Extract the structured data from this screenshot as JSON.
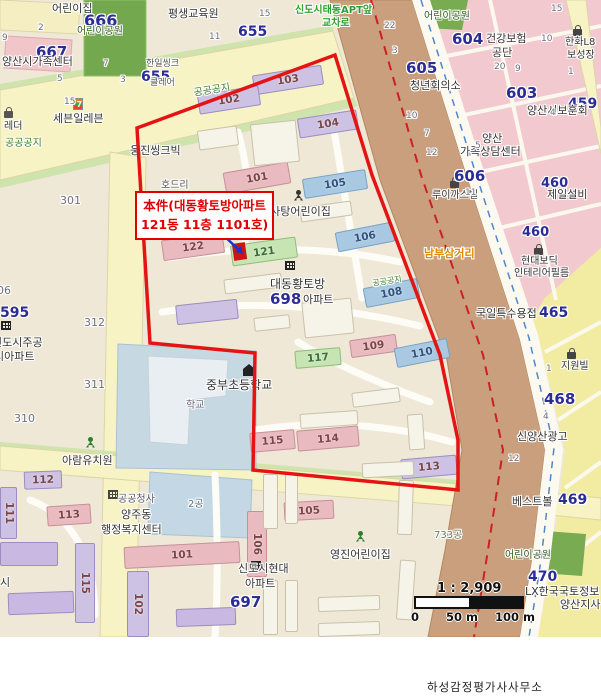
{
  "annotation": {
    "line1": "本件(대동황토방아파트",
    "line2": "121동 11층 1101호)"
  },
  "scale": {
    "ratio": "1 : 2,909",
    "tick0": "0",
    "tick50": "50 m",
    "tick100": "100 m"
  },
  "attribution": "하성감정평가사사무소",
  "colors": {
    "boundary": "#e51414",
    "marker": "#cf1212",
    "arrow": "#1535cc",
    "navy": "#2c2c96",
    "lot": "#6e6e7e",
    "green_text": "#3a7d2e",
    "road": "#f8f3c4",
    "railway": "#c99f7e",
    "pink_zone": "#f2c9ce",
    "yellow_zone": "#f2eca2",
    "park": "#74a84e",
    "school": "#c6d9e3"
  },
  "subject": {
    "boundary_points": "137,128 335,55 372,175 440,355 458,440 458,490 253,470 255,353 150,343",
    "marker": {
      "x": 233,
      "y": 243,
      "w": 13,
      "h": 17,
      "rot": -8
    },
    "arrow": {
      "x1": 221,
      "y1": 233,
      "x2": 238,
      "y2": 249
    }
  },
  "building_styles": {
    "lav": {
      "f": "#cdc2e4",
      "s": "#9b8cc2",
      "lc": "#7a4545"
    },
    "pink": {
      "f": "#e9bac0",
      "s": "#c98f98",
      "lc": "#7a4545"
    },
    "blue": {
      "f": "#a9c9e3",
      "s": "#76a2c6",
      "lc": "#31517d"
    },
    "green": {
      "f": "#c6e5b3",
      "s": "#8fbd7c",
      "lc": "#3c6b3c"
    },
    "white": {
      "f": "#f6f3e8",
      "s": "#c9c1a9",
      "lc": "#999999"
    },
    "purple": {
      "f": "#c9b9e2",
      "s": "#9d8cc0",
      "lc": "#555555"
    }
  },
  "buildings": [
    {
      "l": "103",
      "x": 253,
      "y": 70,
      "w": 70,
      "h": 20,
      "r": -9,
      "k": "lav"
    },
    {
      "l": "102",
      "x": 198,
      "y": 90,
      "w": 62,
      "h": 20,
      "r": -9,
      "k": "lav"
    },
    {
      "l": "104",
      "x": 298,
      "y": 114,
      "w": 60,
      "h": 20,
      "r": -9,
      "k": "lav"
    },
    {
      "l": "101",
      "x": 224,
      "y": 167,
      "w": 66,
      "h": 22,
      "r": -10,
      "k": "pink"
    },
    {
      "l": "105",
      "x": 303,
      "y": 174,
      "w": 64,
      "h": 20,
      "r": -9,
      "k": "blue"
    },
    {
      "l": "122",
      "x": 162,
      "y": 236,
      "w": 62,
      "h": 21,
      "r": -8,
      "k": "pink"
    },
    {
      "l": "121",
      "x": 231,
      "y": 241,
      "w": 66,
      "h": 21,
      "r": -8,
      "k": "green"
    },
    {
      "l": "106",
      "x": 336,
      "y": 227,
      "w": 58,
      "h": 20,
      "r": -11,
      "k": "blue"
    },
    {
      "l": "108",
      "x": 364,
      "y": 283,
      "w": 55,
      "h": 20,
      "r": -11,
      "k": "blue"
    },
    {
      "l": "109",
      "x": 350,
      "y": 337,
      "w": 47,
      "h": 18,
      "r": -8,
      "k": "pink"
    },
    {
      "l": "110",
      "x": 395,
      "y": 343,
      "w": 54,
      "h": 20,
      "r": -11,
      "k": "blue"
    },
    {
      "l": "117",
      "x": 295,
      "y": 349,
      "w": 46,
      "h": 18,
      "r": -5,
      "k": "green"
    },
    {
      "l": "115",
      "x": 250,
      "y": 431,
      "w": 45,
      "h": 20,
      "r": -5,
      "k": "pink"
    },
    {
      "l": "114",
      "x": 297,
      "y": 428,
      "w": 62,
      "h": 21,
      "r": -5,
      "k": "pink"
    },
    {
      "l": "113",
      "x": 401,
      "y": 457,
      "w": 56,
      "h": 20,
      "r": -5,
      "k": "lav"
    },
    {
      "l": "",
      "x": 176,
      "y": 302,
      "w": 62,
      "h": 20,
      "r": -6,
      "k": "lav"
    },
    {
      "l": "112",
      "x": 24,
      "y": 471,
      "w": 38,
      "h": 18,
      "r": -2,
      "k": "lav"
    },
    {
      "l": "111",
      "x": 0,
      "y": 487,
      "w": 17,
      "h": 52,
      "r": 0,
      "k": "lav",
      "v": 1
    },
    {
      "l": "113",
      "x": 47,
      "y": 505,
      "w": 44,
      "h": 20,
      "r": -4,
      "k": "pink"
    },
    {
      "l": "115",
      "x": 75,
      "y": 543,
      "w": 20,
      "h": 80,
      "r": 0,
      "k": "lav",
      "v": 1
    },
    {
      "l": "101",
      "x": 124,
      "y": 544,
      "w": 116,
      "h": 22,
      "r": -3,
      "k": "pink"
    },
    {
      "l": "102",
      "x": 127,
      "y": 571,
      "w": 22,
      "h": 66,
      "r": 0,
      "k": "lav",
      "v": 1
    },
    {
      "l": "106",
      "x": 247,
      "y": 511,
      "w": 20,
      "h": 66,
      "r": 0,
      "k": "pink",
      "v": 1
    },
    {
      "l": "105",
      "x": 284,
      "y": 501,
      "w": 50,
      "h": 19,
      "r": -3,
      "k": "pink"
    },
    {
      "l": "",
      "x": 252,
      "y": 122,
      "w": 46,
      "h": 42,
      "r": -6,
      "k": "white"
    },
    {
      "l": "",
      "x": 198,
      "y": 128,
      "w": 40,
      "h": 20,
      "r": -8,
      "k": "white"
    },
    {
      "l": "",
      "x": 300,
      "y": 204,
      "w": 52,
      "h": 15,
      "r": -8,
      "k": "white"
    },
    {
      "l": "",
      "x": 224,
      "y": 276,
      "w": 58,
      "h": 15,
      "r": -7,
      "k": "white"
    },
    {
      "l": "",
      "x": 303,
      "y": 300,
      "w": 50,
      "h": 36,
      "r": -6,
      "k": "white"
    },
    {
      "l": "",
      "x": 254,
      "y": 316,
      "w": 36,
      "h": 14,
      "r": -6,
      "k": "white"
    },
    {
      "l": "",
      "x": 352,
      "y": 390,
      "w": 48,
      "h": 15,
      "r": -7,
      "k": "white"
    },
    {
      "l": "",
      "x": 300,
      "y": 412,
      "w": 58,
      "h": 15,
      "r": -4,
      "k": "white"
    },
    {
      "l": "",
      "x": 362,
      "y": 462,
      "w": 52,
      "h": 15,
      "r": -3,
      "k": "white"
    },
    {
      "l": "",
      "x": 408,
      "y": 414,
      "w": 16,
      "h": 36,
      "r": -4,
      "k": "white"
    },
    {
      "l": "",
      "x": 263,
      "y": 474,
      "w": 15,
      "h": 55,
      "r": 0,
      "k": "white"
    },
    {
      "l": "",
      "x": 285,
      "y": 474,
      "w": 13,
      "h": 50,
      "r": 0,
      "k": "white"
    },
    {
      "l": "",
      "x": 263,
      "y": 580,
      "w": 15,
      "h": 55,
      "r": 0,
      "k": "white"
    },
    {
      "l": "",
      "x": 285,
      "y": 580,
      "w": 13,
      "h": 52,
      "r": 0,
      "k": "white"
    },
    {
      "l": "",
      "x": 318,
      "y": 596,
      "w": 62,
      "h": 15,
      "r": -2,
      "k": "white"
    },
    {
      "l": "",
      "x": 318,
      "y": 622,
      "w": 62,
      "h": 14,
      "r": -2,
      "k": "white"
    },
    {
      "l": "",
      "x": 398,
      "y": 560,
      "w": 16,
      "h": 60,
      "r": 4,
      "k": "white"
    },
    {
      "l": "",
      "x": 398,
      "y": 480,
      "w": 15,
      "h": 55,
      "r": 2,
      "k": "white"
    },
    {
      "l": "",
      "x": 0,
      "y": 542,
      "w": 58,
      "h": 24,
      "r": 0,
      "k": "purple"
    },
    {
      "l": "",
      "x": 8,
      "y": 592,
      "w": 66,
      "h": 22,
      "r": -2,
      "k": "purple"
    },
    {
      "l": "",
      "x": 176,
      "y": 608,
      "w": 60,
      "h": 18,
      "r": -2,
      "k": "purple"
    }
  ],
  "labels": [
    {
      "t": "어린이집",
      "x": 52,
      "y": 3,
      "s": 11,
      "c": "#333333"
    },
    {
      "t": "666",
      "x": 84,
      "y": 12,
      "s": 16,
      "c": "#2c2c96",
      "b": 1
    },
    {
      "t": "어린이공원",
      "x": 77,
      "y": 26,
      "s": 10,
      "c": "#2e5c1e"
    },
    {
      "t": "667",
      "x": 36,
      "y": 44,
      "s": 15,
      "c": "#2c2c96",
      "b": 1
    },
    {
      "t": "양산시가족센터",
      "x": 2,
      "y": 56,
      "s": 11,
      "c": "#333333"
    },
    {
      "t": "평생교육원",
      "x": 168,
      "y": 8,
      "s": 11,
      "c": "#333333"
    },
    {
      "t": "655",
      "x": 238,
      "y": 25,
      "s": 14,
      "c": "#2c2c96",
      "b": 1
    },
    {
      "t": "15",
      "x": 259,
      "y": 10,
      "s": 9,
      "c": "#6e6e7e"
    },
    {
      "t": "11",
      "x": 209,
      "y": 33,
      "s": 9,
      "c": "#6e6e7e"
    },
    {
      "t": "2",
      "x": 38,
      "y": 24,
      "s": 9,
      "c": "#6e6e7e"
    },
    {
      "t": "9",
      "x": 2,
      "y": 34,
      "s": 9,
      "c": "#6e6e7e"
    },
    {
      "t": "5",
      "x": 57,
      "y": 75,
      "s": 9,
      "c": "#6e6e7e"
    },
    {
      "t": "3",
      "x": 120,
      "y": 76,
      "s": 9,
      "c": "#6e6e7e"
    },
    {
      "t": "7",
      "x": 103,
      "y": 60,
      "s": 9,
      "c": "#6e6e7e"
    },
    {
      "t": "655",
      "x": 141,
      "y": 70,
      "s": 14,
      "c": "#2c2c96",
      "b": 1
    },
    {
      "t": "한일씽크",
      "x": 146,
      "y": 60,
      "s": 9,
      "c": "#555555"
    },
    {
      "t": "클레어",
      "x": 150,
      "y": 79,
      "s": 9,
      "c": "#555555"
    },
    {
      "t": "15",
      "x": 64,
      "y": 98,
      "s": 9,
      "c": "#6e6e7e"
    },
    {
      "t": "세븐일레븐",
      "x": 53,
      "y": 113,
      "s": 11,
      "c": "#333333"
    },
    {
      "t": "레더",
      "x": 4,
      "y": 121,
      "s": 10,
      "c": "#333333"
    },
    {
      "t": "공공공지",
      "x": 5,
      "y": 138,
      "s": 10,
      "c": "#3a7d2e"
    },
    {
      "t": "공공공지",
      "x": 193,
      "y": 88,
      "s": 10,
      "c": "#3a7d2e",
      "r": -9
    },
    {
      "t": "301",
      "x": 60,
      "y": 195,
      "s": 11,
      "c": "#6e6e7e"
    },
    {
      "t": "웅진씽크빅",
      "x": 130,
      "y": 145,
      "s": 11,
      "c": "#333333"
    },
    {
      "t": "호드리",
      "x": 161,
      "y": 180,
      "s": 10,
      "c": "#555555"
    },
    {
      "t": "신도시태동APT앞",
      "x": 295,
      "y": 5,
      "s": 10,
      "c": "#2f9e2f",
      "b": 1
    },
    {
      "t": "교차로",
      "x": 322,
      "y": 18,
      "s": 10,
      "c": "#2f9e2f",
      "b": 1
    },
    {
      "t": "어린이공원",
      "x": 424,
      "y": 11,
      "s": 10,
      "c": "#2e5c1e"
    },
    {
      "t": "22",
      "x": 384,
      "y": 22,
      "s": 9,
      "c": "#6e6e7e"
    },
    {
      "t": "3",
      "x": 392,
      "y": 47,
      "s": 9,
      "c": "#6e6e7e"
    },
    {
      "t": "604",
      "x": 452,
      "y": 31,
      "s": 15,
      "c": "#2c2c96",
      "b": 1
    },
    {
      "t": "건강보험",
      "x": 486,
      "y": 33,
      "s": 11,
      "c": "#333333"
    },
    {
      "t": "공단",
      "x": 492,
      "y": 47,
      "s": 11,
      "c": "#333333"
    },
    {
      "t": "한화L8",
      "x": 565,
      "y": 37,
      "s": 10,
      "c": "#333333"
    },
    {
      "t": "보성장",
      "x": 567,
      "y": 50,
      "s": 10,
      "c": "#333333"
    },
    {
      "t": "15",
      "x": 551,
      "y": 5,
      "s": 9,
      "c": "#6e6e7e"
    },
    {
      "t": "10",
      "x": 541,
      "y": 35,
      "s": 9,
      "c": "#6e6e7e"
    },
    {
      "t": "605",
      "x": 406,
      "y": 60,
      "s": 15,
      "c": "#2c2c96",
      "b": 1
    },
    {
      "t": "청년회의소",
      "x": 410,
      "y": 80,
      "s": 11,
      "c": "#333333"
    },
    {
      "t": "20",
      "x": 494,
      "y": 63,
      "s": 9,
      "c": "#6e6e7e"
    },
    {
      "t": "9",
      "x": 515,
      "y": 65,
      "s": 9,
      "c": "#6e6e7e"
    },
    {
      "t": "1",
      "x": 568,
      "y": 68,
      "s": 9,
      "c": "#6e6e7e"
    },
    {
      "t": "603",
      "x": 506,
      "y": 85,
      "s": 15,
      "c": "#2c2c96",
      "b": 1
    },
    {
      "t": "459",
      "x": 568,
      "y": 97,
      "s": 14,
      "c": "#2c2c96",
      "b": 1
    },
    {
      "t": "양산시보훈회",
      "x": 527,
      "y": 105,
      "s": 11,
      "c": "#333333"
    },
    {
      "t": "4",
      "x": 550,
      "y": 109,
      "s": 9,
      "c": "#6e6e7e"
    },
    {
      "t": "양산",
      "x": 482,
      "y": 133,
      "s": 11,
      "c": "#333333"
    },
    {
      "t": "가족상담센터",
      "x": 460,
      "y": 146,
      "s": 11,
      "c": "#333333"
    },
    {
      "t": "10",
      "x": 406,
      "y": 112,
      "s": 9,
      "c": "#6e6e7e"
    },
    {
      "t": "7",
      "x": 424,
      "y": 130,
      "s": 9,
      "c": "#6e6e7e"
    },
    {
      "t": "12",
      "x": 426,
      "y": 149,
      "s": 9,
      "c": "#6e6e7e"
    },
    {
      "t": "5",
      "x": 475,
      "y": 142,
      "s": 9,
      "c": "#6e6e7e"
    },
    {
      "t": "606",
      "x": 454,
      "y": 168,
      "s": 15,
      "c": "#2c2c96",
      "b": 1
    },
    {
      "t": "460",
      "x": 541,
      "y": 177,
      "s": 13,
      "c": "#2c2c96",
      "b": 1
    },
    {
      "t": "제일설비",
      "x": 547,
      "y": 189,
      "s": 11,
      "c": "#333333"
    },
    {
      "t": "루이까스텔",
      "x": 432,
      "y": 190,
      "s": 10,
      "c": "#333333"
    },
    {
      "t": "11",
      "x": 465,
      "y": 189,
      "s": 9,
      "c": "#6e6e7e"
    },
    {
      "t": "460",
      "x": 522,
      "y": 226,
      "s": 13,
      "c": "#2c2c96",
      "b": 1
    },
    {
      "t": "현대보딕",
      "x": 521,
      "y": 256,
      "s": 10,
      "c": "#333333"
    },
    {
      "t": "인테리어필름",
      "x": 514,
      "y": 268,
      "s": 10,
      "c": "#333333"
    },
    {
      "t": "남부삼거리",
      "x": 424,
      "y": 248,
      "s": 11,
      "c": "#e08a00",
      "b": 1
    },
    {
      "t": "솜사탕어린이집",
      "x": 260,
      "y": 206,
      "s": 11,
      "c": "#333333"
    },
    {
      "t": "대동황토방",
      "x": 270,
      "y": 278,
      "s": 12,
      "c": "#333333"
    },
    {
      "t": "698",
      "x": 270,
      "y": 291,
      "s": 15,
      "c": "#2c2c96",
      "b": 1
    },
    {
      "t": "아파트",
      "x": 303,
      "y": 294,
      "s": 11,
      "c": "#333333"
    },
    {
      "t": "공공공지",
      "x": 372,
      "y": 280,
      "s": 8,
      "c": "#3a7d2e",
      "r": -9
    },
    {
      "t": "중부초등학교",
      "x": 206,
      "y": 379,
      "s": 12,
      "c": "#333333"
    },
    {
      "t": "학교",
      "x": 186,
      "y": 400,
      "s": 10,
      "c": "#666677"
    },
    {
      "t": "06",
      "x": -3,
      "y": 285,
      "s": 11,
      "c": "#6e6e7e"
    },
    {
      "t": "595",
      "x": 0,
      "y": 306,
      "s": 14,
      "c": "#2c2c96",
      "b": 1
    },
    {
      "t": "신도시주공",
      "x": -8,
      "y": 337,
      "s": 11,
      "c": "#333333"
    },
    {
      "t": "시아파트",
      "x": -6,
      "y": 351,
      "s": 11,
      "c": "#333333"
    },
    {
      "t": "312",
      "x": 84,
      "y": 317,
      "s": 11,
      "c": "#6e6e7e"
    },
    {
      "t": "311",
      "x": 84,
      "y": 379,
      "s": 11,
      "c": "#6e6e7e"
    },
    {
      "t": "310",
      "x": 14,
      "y": 413,
      "s": 11,
      "c": "#6e6e7e"
    },
    {
      "t": "아람유치원",
      "x": 62,
      "y": 455,
      "s": 11,
      "c": "#333333"
    },
    {
      "t": "공공청사",
      "x": 118,
      "y": 494,
      "s": 10,
      "c": "#555566"
    },
    {
      "t": "양주동",
      "x": 121,
      "y": 509,
      "s": 11,
      "c": "#333333"
    },
    {
      "t": "행정복지센터",
      "x": 101,
      "y": 524,
      "s": 11,
      "c": "#333333"
    },
    {
      "t": "2공",
      "x": 188,
      "y": 499,
      "s": 10,
      "c": "#5a7080"
    },
    {
      "t": "시",
      "x": 0,
      "y": 577,
      "s": 11,
      "c": "#333333"
    },
    {
      "t": "신도시현대",
      "x": 238,
      "y": 563,
      "s": 11,
      "c": "#333333"
    },
    {
      "t": "아파트",
      "x": 245,
      "y": 578,
      "s": 11,
      "c": "#333333"
    },
    {
      "t": "697",
      "x": 230,
      "y": 594,
      "s": 15,
      "c": "#2c2c96",
      "b": 1
    },
    {
      "t": "영진어린이집",
      "x": 330,
      "y": 549,
      "s": 11,
      "c": "#333333"
    },
    {
      "t": "733공",
      "x": 434,
      "y": 530,
      "s": 10,
      "c": "#6a7a5a"
    },
    {
      "t": "지원빌",
      "x": 561,
      "y": 361,
      "s": 10,
      "c": "#333333"
    },
    {
      "t": "국일특수용접",
      "x": 476,
      "y": 308,
      "s": 11,
      "c": "#333333"
    },
    {
      "t": "465",
      "x": 539,
      "y": 306,
      "s": 14,
      "c": "#2c2c96",
      "b": 1
    },
    {
      "t": "468",
      "x": 544,
      "y": 391,
      "s": 15,
      "c": "#2c2c96",
      "b": 1
    },
    {
      "t": "1",
      "x": 546,
      "y": 365,
      "s": 9,
      "c": "#6e6e7e"
    },
    {
      "t": "4",
      "x": 543,
      "y": 413,
      "s": 9,
      "c": "#6e6e7e"
    },
    {
      "t": "신양산광고",
      "x": 517,
      "y": 431,
      "s": 11,
      "c": "#333333"
    },
    {
      "t": "12",
      "x": 508,
      "y": 455,
      "s": 9,
      "c": "#6e6e7e"
    },
    {
      "t": "베스트볼",
      "x": 512,
      "y": 496,
      "s": 11,
      "c": "#333333"
    },
    {
      "t": "469",
      "x": 558,
      "y": 493,
      "s": 14,
      "c": "#2c2c96",
      "b": 1
    },
    {
      "t": "어린이공원",
      "x": 505,
      "y": 550,
      "s": 10,
      "c": "#2e5c1e"
    },
    {
      "t": "470",
      "x": 528,
      "y": 570,
      "s": 14,
      "c": "#2c2c96",
      "b": 1
    },
    {
      "t": "LX한국국토정보",
      "x": 525,
      "y": 586,
      "s": 11,
      "c": "#333333"
    },
    {
      "t": "양산지사",
      "x": 560,
      "y": 599,
      "s": 11,
      "c": "#333333"
    }
  ],
  "icons": [
    {
      "k": "seven",
      "x": 73,
      "y": 98,
      "c": "#333333",
      "n": "seven-eleven-icon"
    },
    {
      "k": "bag",
      "x": 4,
      "y": 107,
      "c": "#555555",
      "n": "shop-bag-icon"
    },
    {
      "k": "bag",
      "x": 573,
      "y": 25,
      "c": "#444444",
      "n": "shop-bag-icon"
    },
    {
      "k": "bag",
      "x": 450,
      "y": 177,
      "c": "#444444",
      "n": "shop-bag-icon"
    },
    {
      "k": "bag",
      "x": 534,
      "y": 244,
      "c": "#444444",
      "n": "shop-bag-icon"
    },
    {
      "k": "bag",
      "x": 567,
      "y": 348,
      "c": "#444444",
      "n": "shop-bag-icon"
    },
    {
      "k": "person",
      "x": 294,
      "y": 190,
      "c": "#333333",
      "n": "daycare-person-icon"
    },
    {
      "k": "person",
      "x": 86,
      "y": 437,
      "c": "#2e7d32",
      "n": "kindergarten-person-icon"
    },
    {
      "k": "person",
      "x": 356,
      "y": 531,
      "c": "#2e7d32",
      "n": "daycare-person-icon"
    },
    {
      "k": "grid",
      "x": 285,
      "y": 261,
      "c": "#222222",
      "n": "apartment-icon"
    },
    {
      "k": "grid",
      "x": 1,
      "y": 321,
      "c": "#222222",
      "n": "apartment-icon"
    },
    {
      "k": "grid",
      "x": 108,
      "y": 490,
      "c": "#444444",
      "n": "government-office-icon"
    },
    {
      "k": "grid",
      "x": 251,
      "y": 561,
      "c": "#222222",
      "n": "apartment-icon"
    },
    {
      "k": "school",
      "x": 243,
      "y": 364,
      "c": "#222222",
      "n": "school-icon"
    }
  ]
}
